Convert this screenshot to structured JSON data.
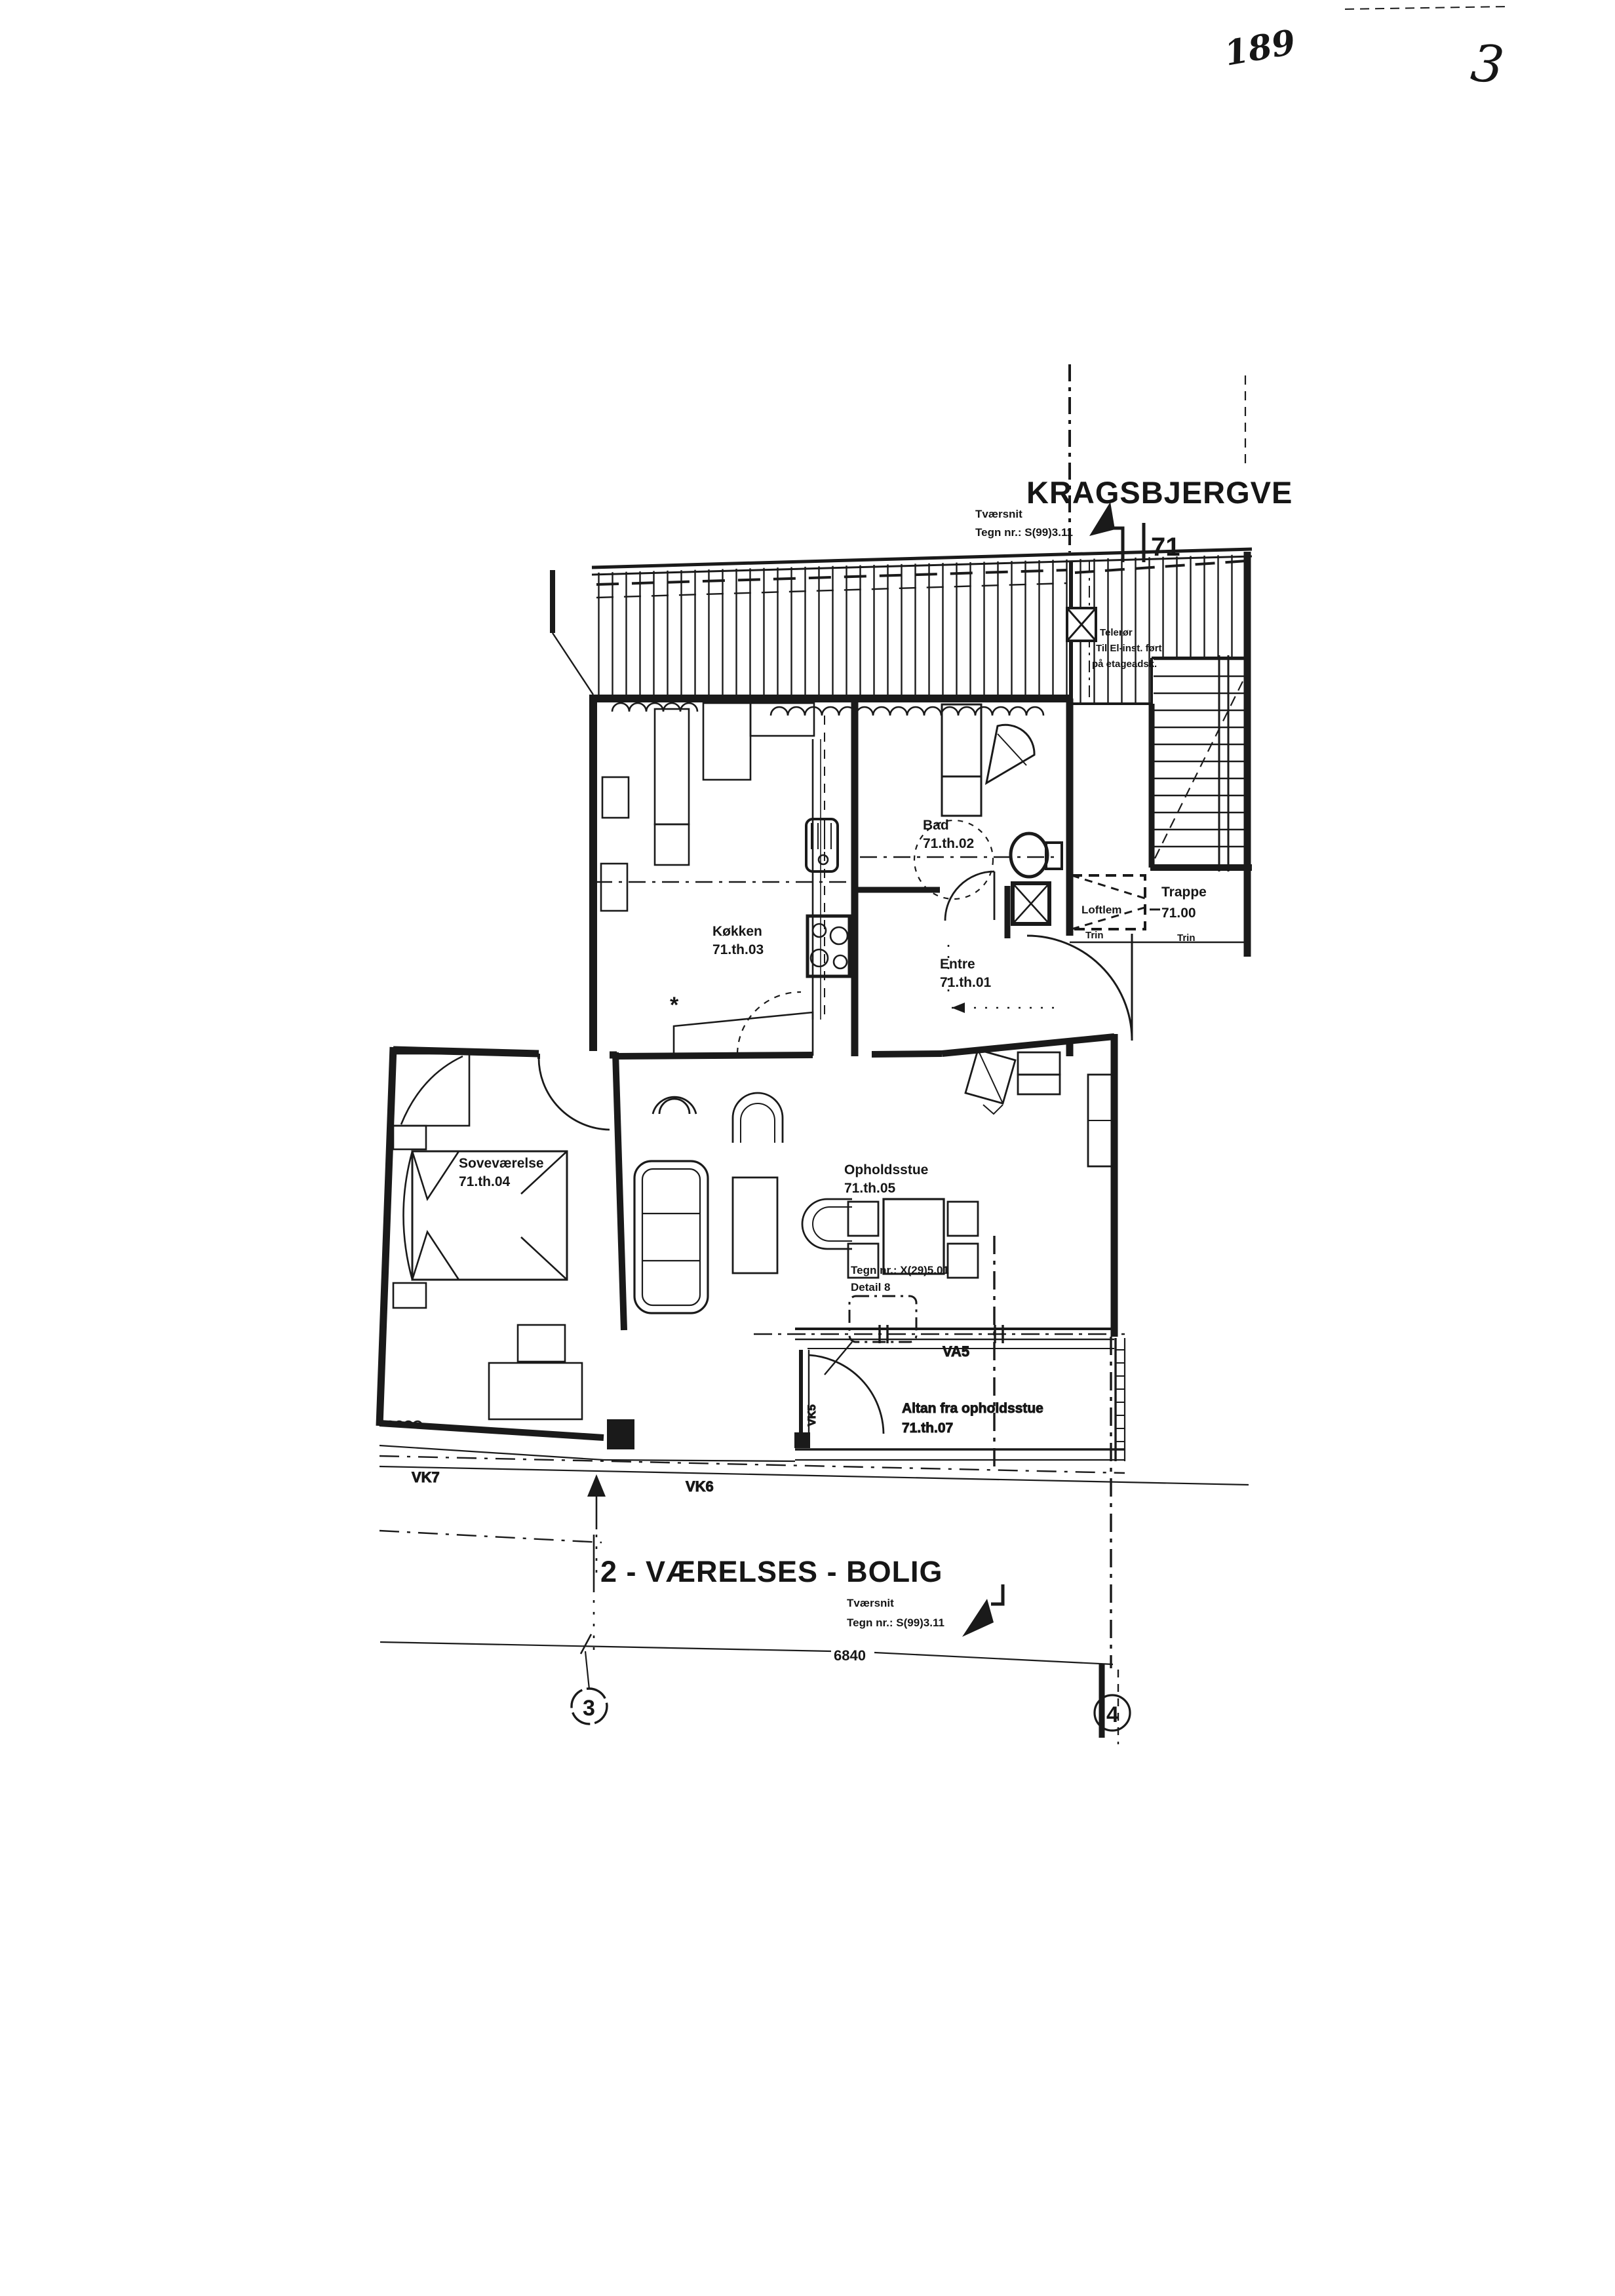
{
  "handwriting": {
    "number": "189",
    "page": "3"
  },
  "header": {
    "street": "KRAGSBJERGVE",
    "grid_ref": "71",
    "section_label": "Tværsnit",
    "section_drawing_no": "Tegn nr.: S(99)3.11"
  },
  "shaft_note": {
    "line1": "Telerør",
    "line2": "Til El-inst. ført",
    "line3": "på etageadsk."
  },
  "rooms": {
    "bad": {
      "name": "Bad",
      "id": "71.th.02"
    },
    "koekken": {
      "name": "Køkken",
      "id": "71.th.03"
    },
    "entre": {
      "name": "Entre",
      "id": "71.th.01"
    },
    "sovevaerelse": {
      "name": "Soveværelse",
      "id": "71.th.04"
    },
    "opholdsstue": {
      "name": "Opholdsstue",
      "id": "71.th.05"
    },
    "trappe": {
      "name": "Trappe",
      "id": "71.00"
    },
    "altan": {
      "name": "Altan fra opholdsstue",
      "id": "71.th.07"
    }
  },
  "stair_labels": {
    "loftlem": "Loftlem",
    "trin_left": "Trin",
    "trin_right": "Trin"
  },
  "detail_callout": {
    "line1": "Tegn nr.: X(29)5.01",
    "line2": "Detail 8"
  },
  "openings": {
    "va5": "VA5",
    "vk5": "VK5",
    "vk6": "VK6",
    "vk7": "VK7",
    "asterisk": "*"
  },
  "footer": {
    "title": "2 - VÆRELSES - BOLIG",
    "section_label": "Tværsnit",
    "section_drawing_no": "Tegn nr.: S(99)3.11",
    "dimension": "6840",
    "grid_left": "3",
    "grid_right": "4"
  }
}
